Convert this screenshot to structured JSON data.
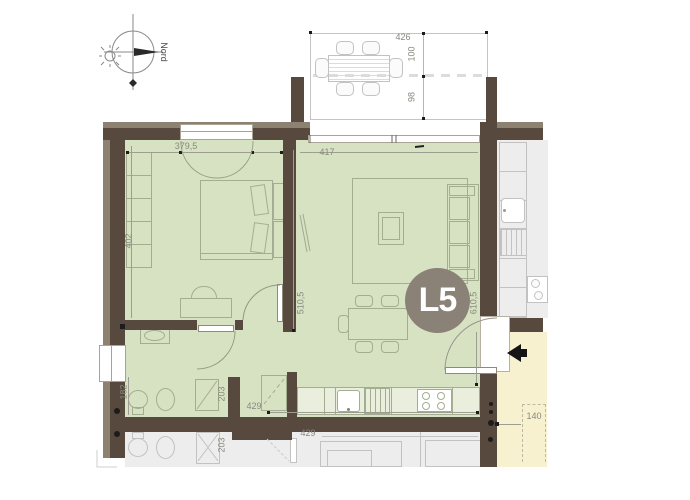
{
  "unit": {
    "label": "L5"
  },
  "compass": {
    "label": "Nord"
  },
  "colors": {
    "wall": "#57493d",
    "wall_light": "#8d8172",
    "floor_green": "#d7e2c3",
    "floor_gray": "#ededed",
    "corridor_yellow": "#f8f1cf",
    "badge": "#8a8177",
    "dim_text": "#87897d",
    "furn_line": "#a3ae90",
    "gray_line": "#c2c2c2"
  },
  "dimensions": {
    "balcony_width": "426",
    "balcony_depth_upper": "100",
    "balcony_depth_lower": "98",
    "bedroom_width": "379,5",
    "bedroom_depth": "402",
    "living_width": "417",
    "living_depth_left": "510,5",
    "living_depth_right": "610,5",
    "kitchen_run": "429",
    "bathroom_width": "182",
    "bathroom_depth": "203",
    "corridor_width": "140",
    "neighbor_bath_depth": "203",
    "neighbor_kitchen_run": "429"
  }
}
